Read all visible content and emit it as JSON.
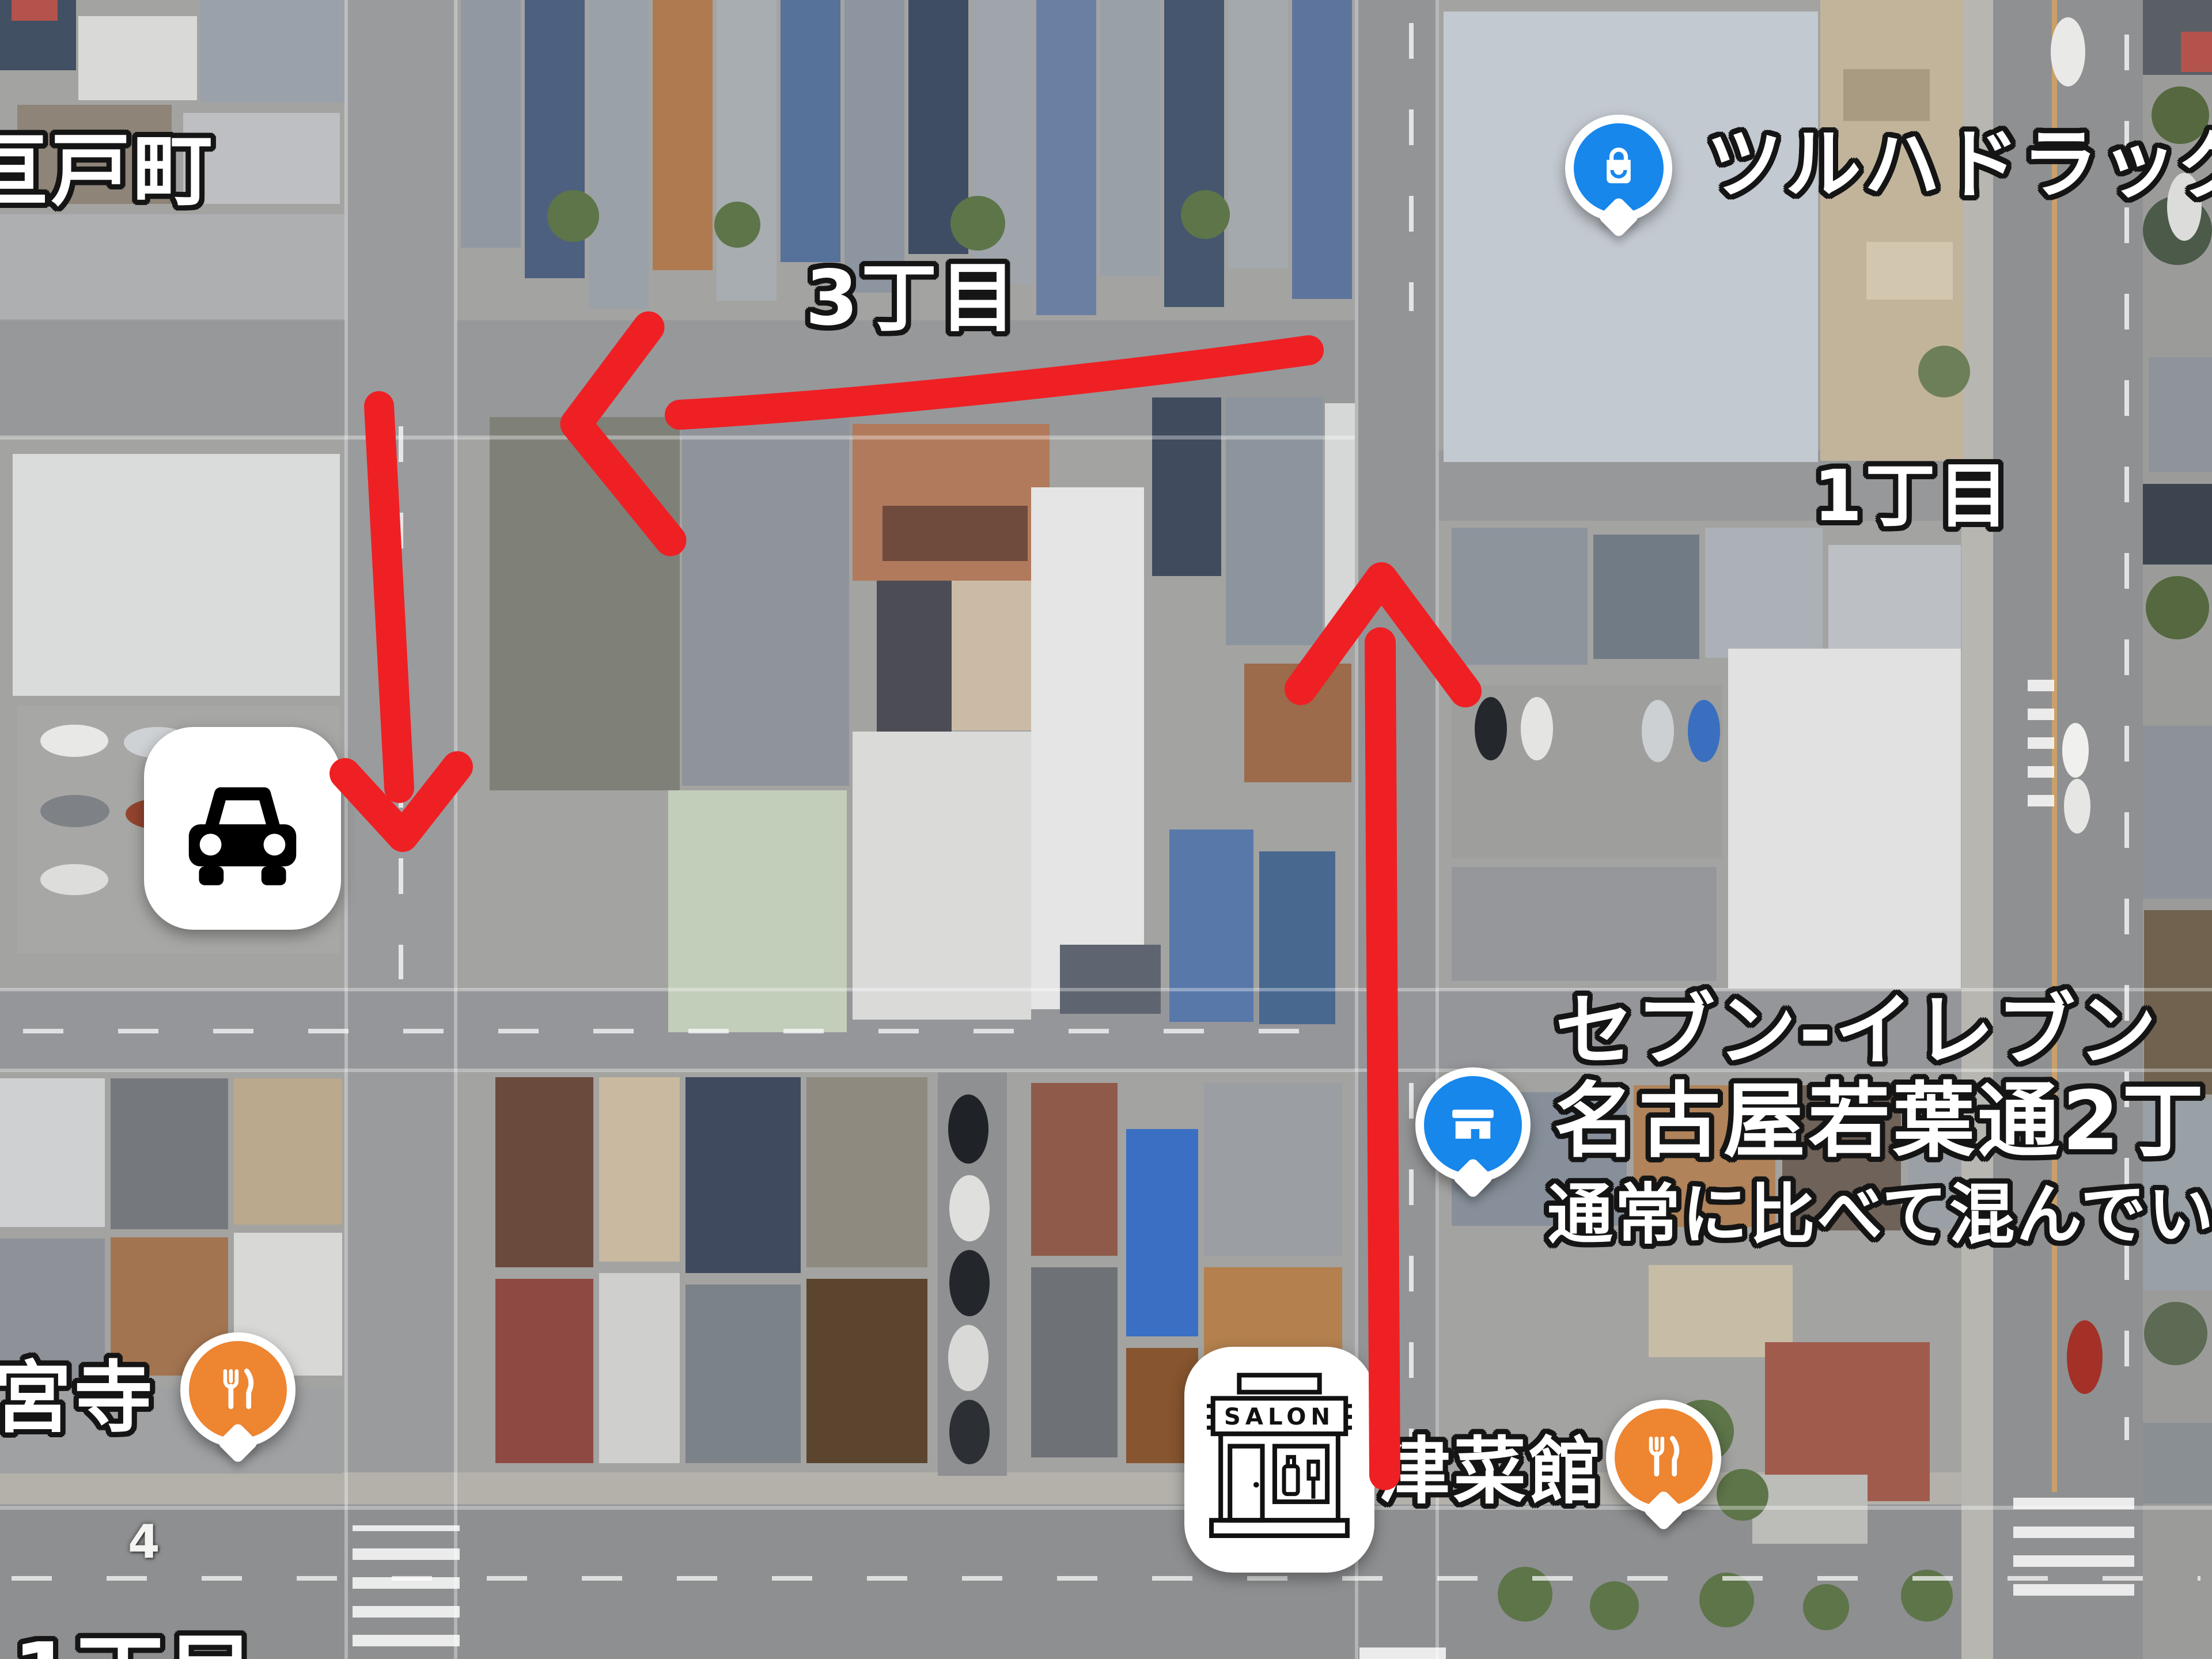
{
  "map_overlay": {
    "arrow_color": "#ee2024",
    "arrows": [
      {
        "id": "turn-west",
        "direction": "left"
      },
      {
        "id": "leg-south",
        "direction": "down"
      },
      {
        "id": "leg-north",
        "direction": "up"
      }
    ],
    "stickers": {
      "car": {
        "icon": "car-icon"
      },
      "salon": {
        "icon": "storefront-icon",
        "sign": "SALON"
      }
    }
  },
  "place_labels": {
    "district_nw": "亘戸町",
    "chome_3": "3丁目",
    "chome_1_east": "1丁目",
    "chome_1_south": "1丁目",
    "temple_sw": "宮寺",
    "restaurant_east_name": "津菜館",
    "house_number": "4"
  },
  "pois": {
    "tsuruha": {
      "name": "ツルハドラッグ",
      "pin_color": "#1787ec",
      "icon": "shopping-bag-icon"
    },
    "seven_eleven": {
      "line1": "セブン-イレブン",
      "line2": "名古屋若葉通2丁目店",
      "line3": "通常に比べて混んでいませ",
      "pin_color": "#1787ec",
      "icon": "convenience-store-icon"
    },
    "restaurant_west": {
      "pin_color": "#ee8531",
      "icon": "fork-knife-icon"
    },
    "restaurant_east": {
      "pin_color": "#ee8531",
      "icon": "fork-knife-icon"
    }
  }
}
